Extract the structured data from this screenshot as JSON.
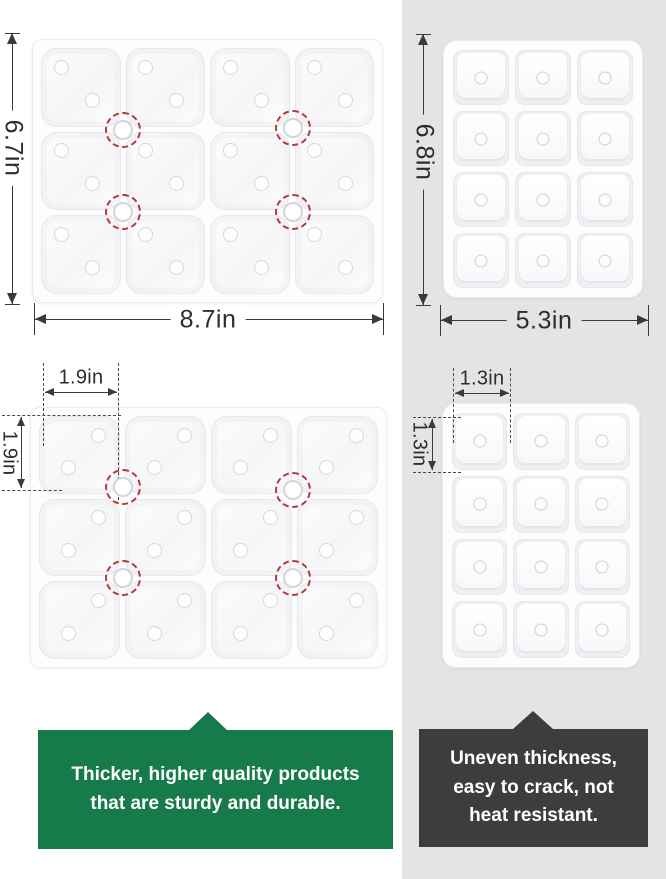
{
  "colors": {
    "right_panel_bg": "#e4e4e4",
    "good_callout_bg": "#177a4b",
    "bad_callout_bg": "#3d3d3d",
    "dimension_line": "#3a3a3a",
    "highlight_ring": "#b23a3a"
  },
  "trays": {
    "large": {
      "cols": 4,
      "rows": 3,
      "compartments": 12
    },
    "small": {
      "cols": 3,
      "rows": 4,
      "compartments": 12
    }
  },
  "good_product": {
    "tray_width_label": "8.7in",
    "tray_height_label": "6.7in",
    "cell_width_label": "1.9in",
    "cell_height_label": "1.9in",
    "caption_lines": [
      "Thicker, higher quality products",
      "that are sturdy and durable."
    ]
  },
  "bad_product": {
    "tray_width_label": "5.3in",
    "tray_height_label": "6.8in",
    "cell_width_label": "1.3in",
    "cell_height_label": "1.3in",
    "caption_lines": [
      "Uneven thickness,",
      "easy to crack, not",
      "heat resistant."
    ]
  }
}
